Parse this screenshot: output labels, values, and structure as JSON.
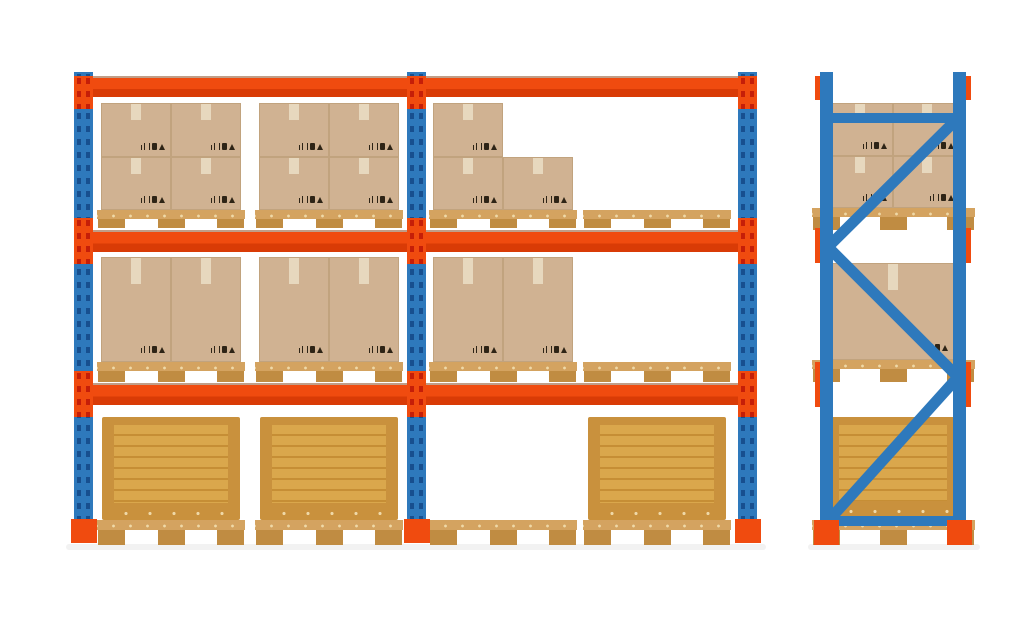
{
  "illustration": {
    "title": "warehouse-pallet-racking",
    "background": "#FFFFFF"
  },
  "palette": {
    "background": "#FFFFFF",
    "post_blue": "#2E79BC",
    "post_hole": "#174F8F",
    "beam_orange": "#F04B0F",
    "beam_shade": "#D93B06",
    "bracket_pin": "#C51E08",
    "foot_orange": "#F04B0F",
    "cardboard": "#D0B292",
    "cardboard_edge": "#C1A37E",
    "tape": "#E9DCC3",
    "label_ink": "#2E2416",
    "pallet_deck": "#D4A360",
    "pallet_block": "#C08C42",
    "pallet_nail": "#EFD9A8",
    "crate_frame": "#C9913D",
    "crate_panel": "#DAA74C",
    "crate_stripe": "#C68E35",
    "floor_shadow": "#EDEDED"
  },
  "front_rack": {
    "name": "double-bay-pallet-rack-front-view",
    "upright_count": 3,
    "beam_count": 3,
    "levels": [
      {
        "id": "top",
        "slots": [
          "boxes-2x2",
          "boxes-2x2",
          "boxes-l-stack",
          "empty-pallet"
        ]
      },
      {
        "id": "middle",
        "slots": [
          "boxes-2-tall",
          "boxes-2-tall",
          "boxes-2-tall",
          "empty-pallet"
        ]
      },
      {
        "id": "bottom",
        "slots": [
          "wooden-crate",
          "wooden-crate",
          "empty-pallet",
          "wooden-crate"
        ]
      }
    ]
  },
  "side_rack": {
    "name": "pallet-rack-side-view",
    "levels": [
      {
        "id": "top",
        "load": "boxes-2x2"
      },
      {
        "id": "middle",
        "load": "box-single"
      },
      {
        "id": "bottom",
        "load": "wooden-crate"
      }
    ]
  }
}
